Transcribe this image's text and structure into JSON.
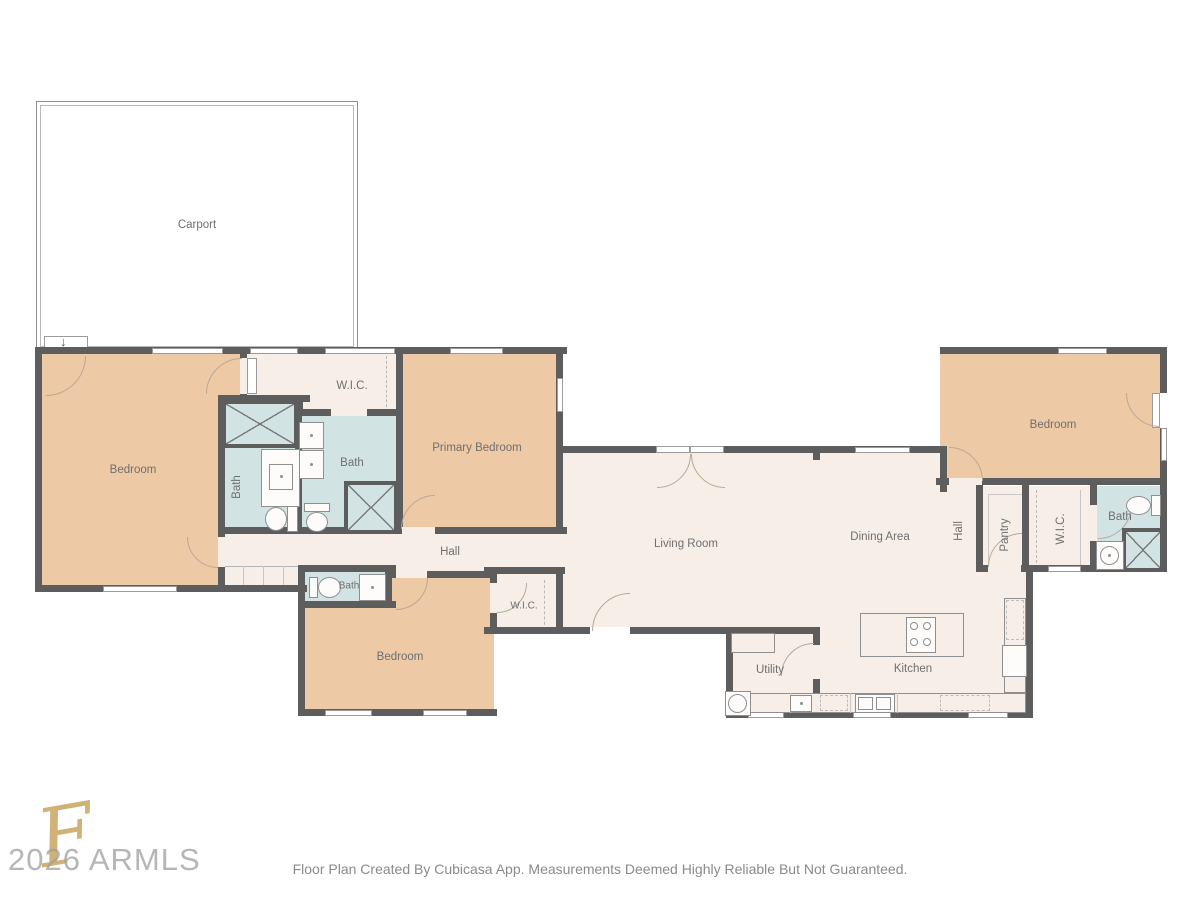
{
  "rooms": {
    "carport": {
      "label": "Carport"
    },
    "bedroom_left": {
      "label": "Bedroom"
    },
    "bath_left": {
      "label": "Bath"
    },
    "wic_primary": {
      "label": "W.I.C."
    },
    "bath_primary": {
      "label": "Bath"
    },
    "primary_bedroom": {
      "label": "Primary Bedroom"
    },
    "hall": {
      "label": "Hall"
    },
    "bath_hall": {
      "label": "Bath"
    },
    "bedroom_bottom": {
      "label": "Bedroom"
    },
    "wic_bottom": {
      "label": "W.I.C."
    },
    "living_room": {
      "label": "Living Room"
    },
    "dining_area": {
      "label": "Dining Area"
    },
    "hall_right": {
      "label": "Hall"
    },
    "pantry": {
      "label": "Pantry"
    },
    "wic_right": {
      "label": "W.I.C."
    },
    "bath_right": {
      "label": "Bath"
    },
    "bedroom_right": {
      "label": "Bedroom"
    },
    "utility": {
      "label": "Utility"
    },
    "kitchen": {
      "label": "Kitchen"
    }
  },
  "icons": {
    "entry_arrow": "↓"
  },
  "watermark": {
    "monogram": "F",
    "text": "2026 ARMLS"
  },
  "footer": {
    "disclaimer": "Floor Plan Created By Cubicasa App. Measurements Deemed Highly Reliable But Not Guaranteed."
  },
  "colors": {
    "wall": "#5d5d5d",
    "bedroom_fill": "#edc9a5",
    "hall_fill": "#f7efe7",
    "bath_fill": "#d2e3e4",
    "fixture_line": "#8f8f8f",
    "door_arc": "#b9a896",
    "label": "#6f6f6f",
    "watermark_gold": "#c9a55f",
    "watermark_gray": "#9e9e9e",
    "footer_text": "#8a8a8a"
  }
}
